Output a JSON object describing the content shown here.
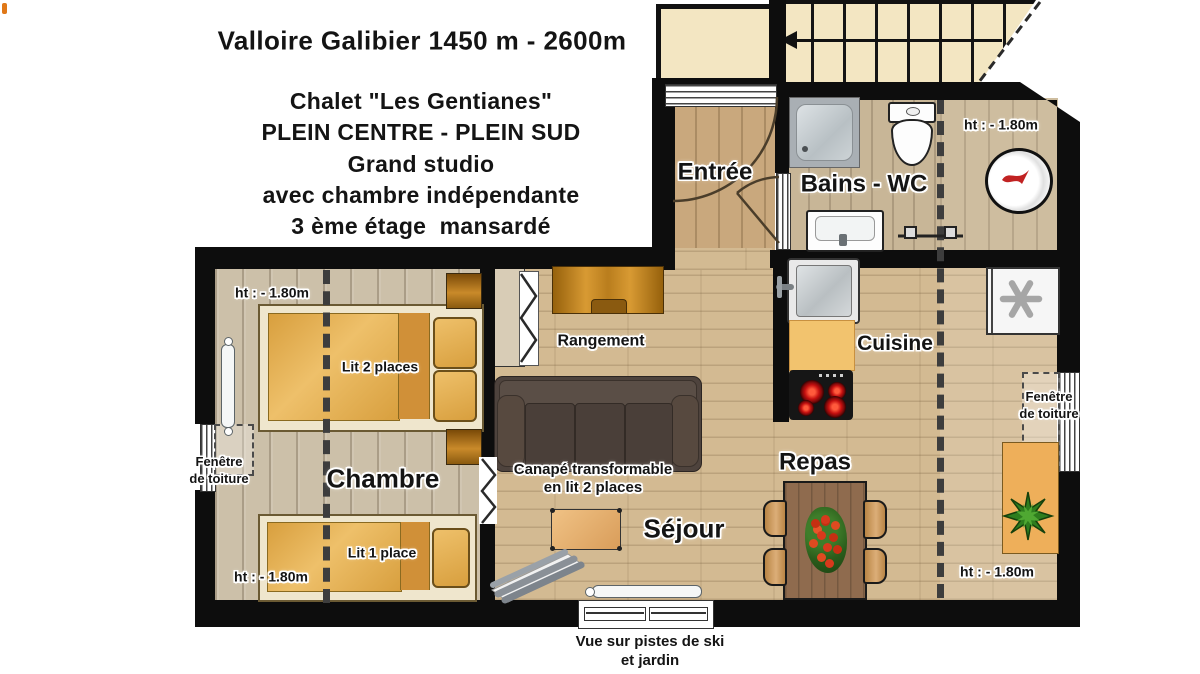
{
  "header": {
    "title": "Valloire Galibier 1450 m - 2600m",
    "subtitle_lines": [
      "Chalet \"Les Gentianes\"",
      "PLEIN CENTRE - PLEIN SUD",
      "Grand studio",
      "avec chambre indépendante",
      "3 ème étage  mansardé"
    ]
  },
  "rooms": {
    "entree": "Entrée",
    "bains_wc": "Bains - WC",
    "cuisine": "Cuisine",
    "rangement": "Rangement",
    "chambre": "Chambre",
    "sejour": "Séjour",
    "repas": "Repas"
  },
  "annotations": {
    "ceiling_height": "ht : - 1.80m",
    "double_bed": "Lit 2 places",
    "single_bed": "Lit 1 place",
    "sofa_line1": "Canapé transformable",
    "sofa_line2": "en lit 2 places",
    "roof_window_line1": "Fenêtre",
    "roof_window_line2": "de toiture",
    "view_line1": "Vue sur pistes de ski",
    "view_line2": "et jardin"
  },
  "colors": {
    "wall": "#0d0d0d",
    "floor_warm": "#d3ba92",
    "floor_cool": "#ccc0a9",
    "stairs_landing": "#f3e6c2",
    "bed_mattress": "#e2a94f",
    "sofa": "#4e433d",
    "wood_furniture": "#b97d1d",
    "dining_table": "#8f6b4e",
    "kitchen_counter": "#f2c36e",
    "burner_red": "#c40f0f",
    "plant_green": "#2e7d1e",
    "logo_red": "#c12222"
  }
}
